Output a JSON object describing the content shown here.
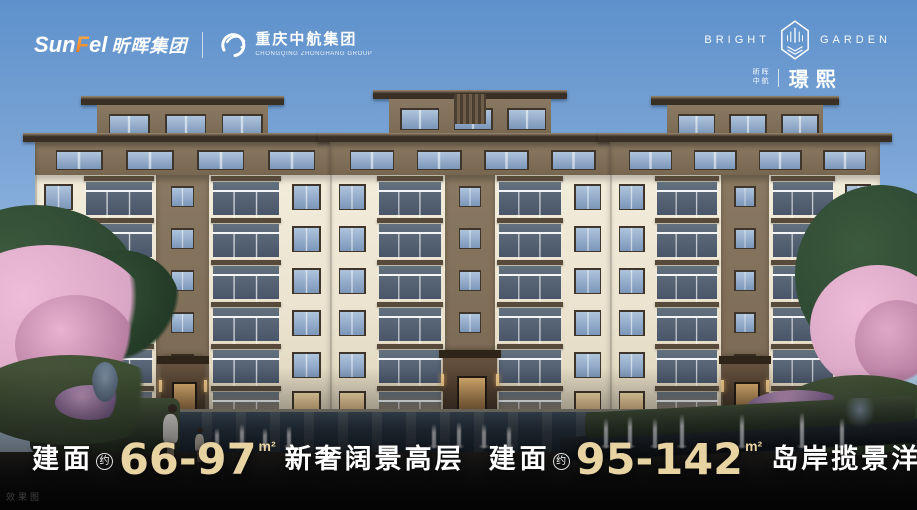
{
  "header": {
    "sunfel": {
      "word_pre": "Sun",
      "word_accent": "F",
      "word_post": "el",
      "cn": "昕晖集团"
    },
    "divider": "|",
    "partner": {
      "cn": "重庆中航集团",
      "en": "CHONGQING ZHONGHANG GROUP"
    }
  },
  "brand": {
    "word_left": "BRIGHT",
    "word_right": "GARDEN",
    "sub_line1": "昕晖",
    "sub_line2": "中航",
    "name": "璟熙"
  },
  "slogan": {
    "items": [
      {
        "prefix": "建面",
        "approx": "约",
        "range": "66-97",
        "unit": "m²",
        "text": "新奢阔景高层"
      },
      {
        "prefix": "建面",
        "approx": "约",
        "range": "95-142",
        "unit": "m²",
        "text": "岛岸揽景洋房"
      }
    ]
  },
  "watermark": "效果图",
  "colors": {
    "accent_gold": "#e8d3a3",
    "sky_top": "#5e91cb",
    "sky_horizon": "#d8e6f2",
    "wall_cream": "#ebe3cf",
    "wall_brown": "#8a7962",
    "wall_brown_dark": "#776650",
    "roof_dark": "#3a2f25",
    "roof_edge": "#9b8a72",
    "window_frame": "#3f352a",
    "glass_light": "#aec4dd",
    "glass_dark": "#7b96b8",
    "lit_window": "#e9c98f",
    "water_dark": "#1c2630",
    "blossom_pink": "#d9a6c5",
    "foliage_green": "#2d4731",
    "hedge_green": "#3d4f32"
  }
}
